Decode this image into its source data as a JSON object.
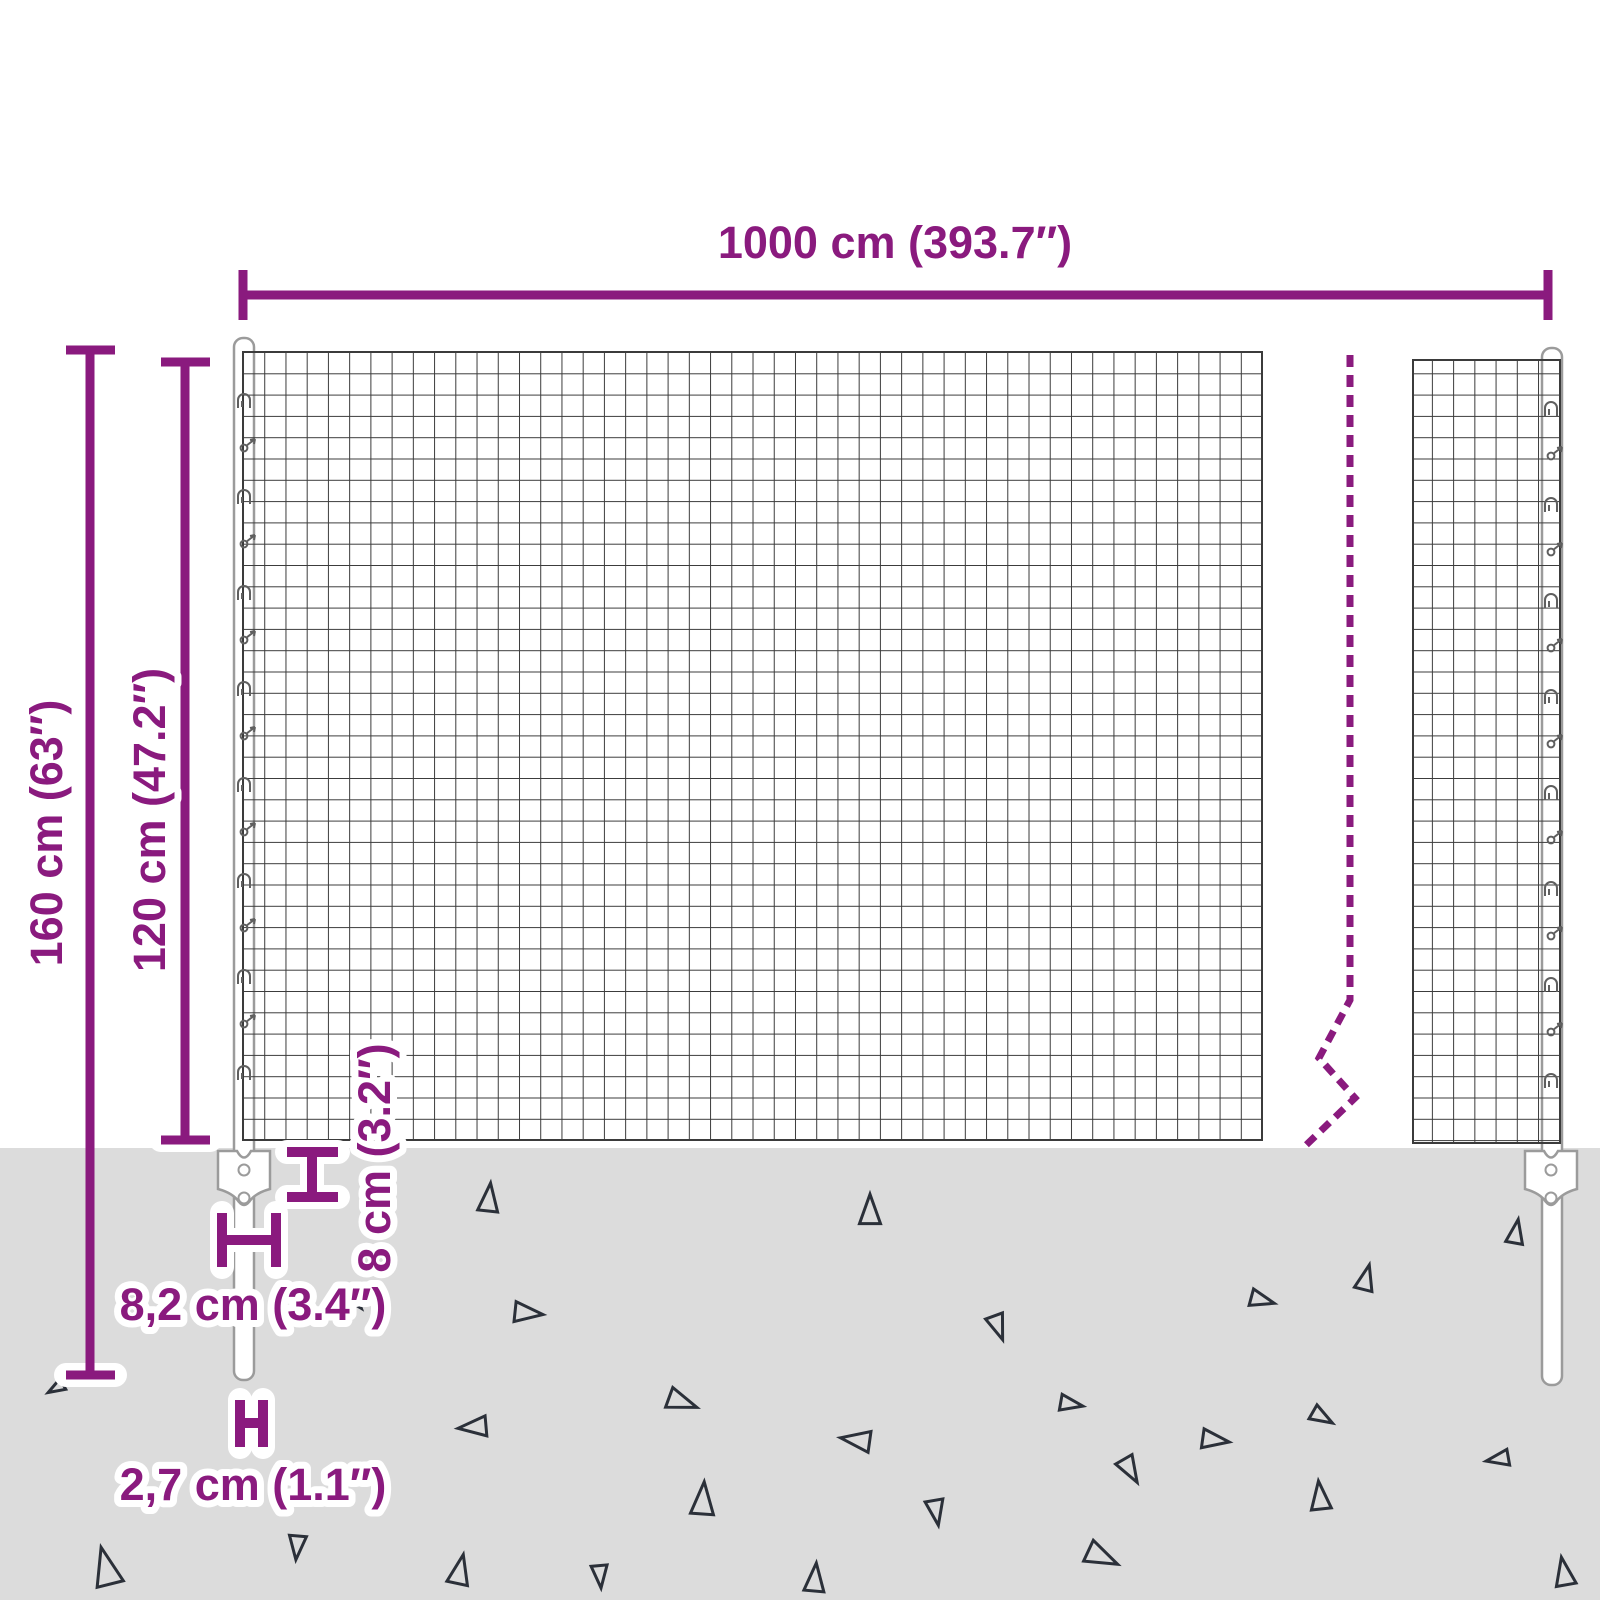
{
  "colors": {
    "accent": "#8a1a7e",
    "ground": "#dcdcdc",
    "mesh_line": "#3b3b3b",
    "post_stroke": "#9b9b9b",
    "triangle": "#2b3039"
  },
  "labels": {
    "width": "1000 cm (393.7″)",
    "total_height": "160 cm (63″)",
    "mesh_height": "120 cm (47.2″)",
    "ground_clearance": "8 cm (3.2″)",
    "anchor_width": "8,2 cm (3.4″)",
    "post_width": "2,7 cm (1.1″)"
  },
  "ground": {
    "triangles": [
      {
        "x": 489,
        "y": 1198,
        "s": 1.0,
        "r": 6
      },
      {
        "x": 870,
        "y": 1210,
        "s": 1.05,
        "r": 0
      },
      {
        "x": 1516,
        "y": 1232,
        "s": 0.85,
        "r": 10
      },
      {
        "x": 1366,
        "y": 1278,
        "s": 0.9,
        "r": 14
      },
      {
        "x": 1262,
        "y": 1300,
        "s": 0.85,
        "r": 105
      },
      {
        "x": 528,
        "y": 1313,
        "s": 1.0,
        "r": 96
      },
      {
        "x": 998,
        "y": 1327,
        "s": 0.9,
        "r": 160
      },
      {
        "x": 356,
        "y": 1302,
        "s": 0.55,
        "r": 140
      },
      {
        "x": 682,
        "y": 1402,
        "s": 1.05,
        "r": 110
      },
      {
        "x": 473,
        "y": 1427,
        "s": 1.0,
        "r": -95
      },
      {
        "x": 1071,
        "y": 1404,
        "s": 0.8,
        "r": 100
      },
      {
        "x": 856,
        "y": 1440,
        "s": 1.05,
        "r": -82
      },
      {
        "x": 1215,
        "y": 1440,
        "s": 0.95,
        "r": 98
      },
      {
        "x": 1322,
        "y": 1417,
        "s": 0.8,
        "r": 120
      },
      {
        "x": 1498,
        "y": 1459,
        "s": 0.8,
        "r": -100
      },
      {
        "x": 1130,
        "y": 1470,
        "s": 0.95,
        "r": 150
      },
      {
        "x": 1320,
        "y": 1496,
        "s": 1.0,
        "r": -6
      },
      {
        "x": 703,
        "y": 1499,
        "s": 1.15,
        "r": 4
      },
      {
        "x": 936,
        "y": 1512,
        "s": 0.9,
        "r": 170
      },
      {
        "x": 1102,
        "y": 1557,
        "s": 1.15,
        "r": 115
      },
      {
        "x": 106,
        "y": 1567,
        "s": 1.35,
        "r": -14
      },
      {
        "x": 297,
        "y": 1547,
        "s": 0.85,
        "r": 185
      },
      {
        "x": 460,
        "y": 1570,
        "s": 1.05,
        "r": 12
      },
      {
        "x": 600,
        "y": 1576,
        "s": 0.8,
        "r": 175
      },
      {
        "x": 815,
        "y": 1578,
        "s": 1.0,
        "r": 5
      },
      {
        "x": 1564,
        "y": 1572,
        "s": 1.0,
        "r": -10
      },
      {
        "x": 56,
        "y": 1388,
        "s": 0.6,
        "r": -120
      }
    ]
  }
}
